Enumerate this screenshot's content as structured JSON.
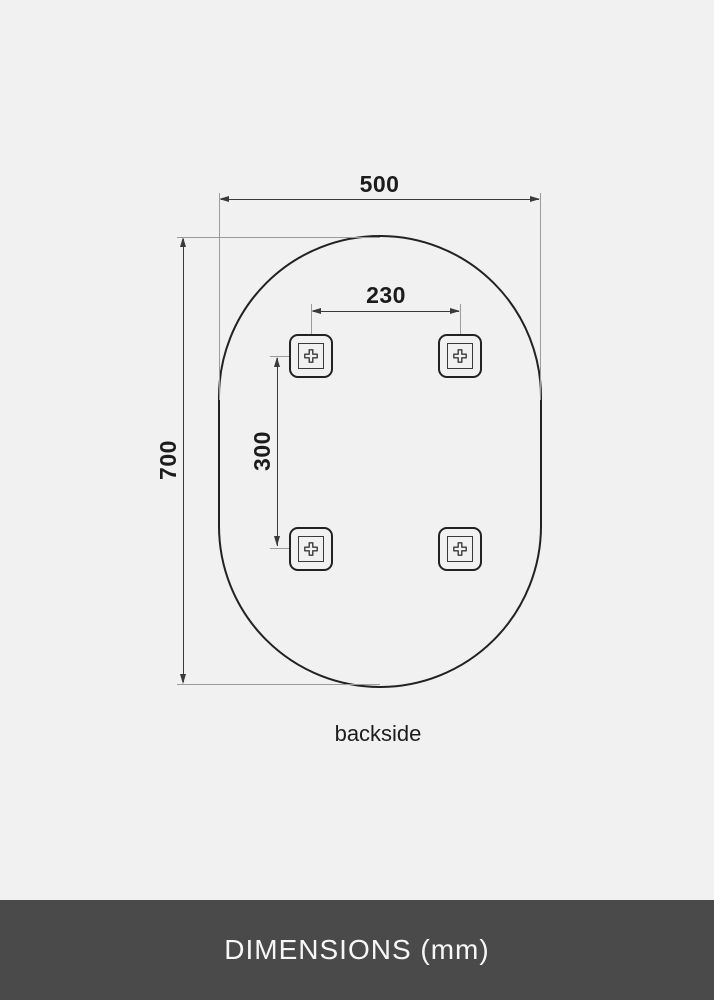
{
  "diagram": {
    "caption": "backside",
    "dims": {
      "width": "500",
      "height": "700",
      "hole_spacing_x": "230",
      "hole_spacing_y": "300"
    },
    "shape": "oval",
    "bracket_count": 4
  },
  "footer": {
    "title": "DIMENSIONS (mm)"
  },
  "colors": {
    "bg": "#f1f1f1",
    "ink": "#222222",
    "dim_line": "#3a3a3a",
    "ext_line": "#9b9b9b",
    "text": "#1c1c1c",
    "footer_bg": "#4a4a4a",
    "footer_text": "#f7f7f7"
  }
}
